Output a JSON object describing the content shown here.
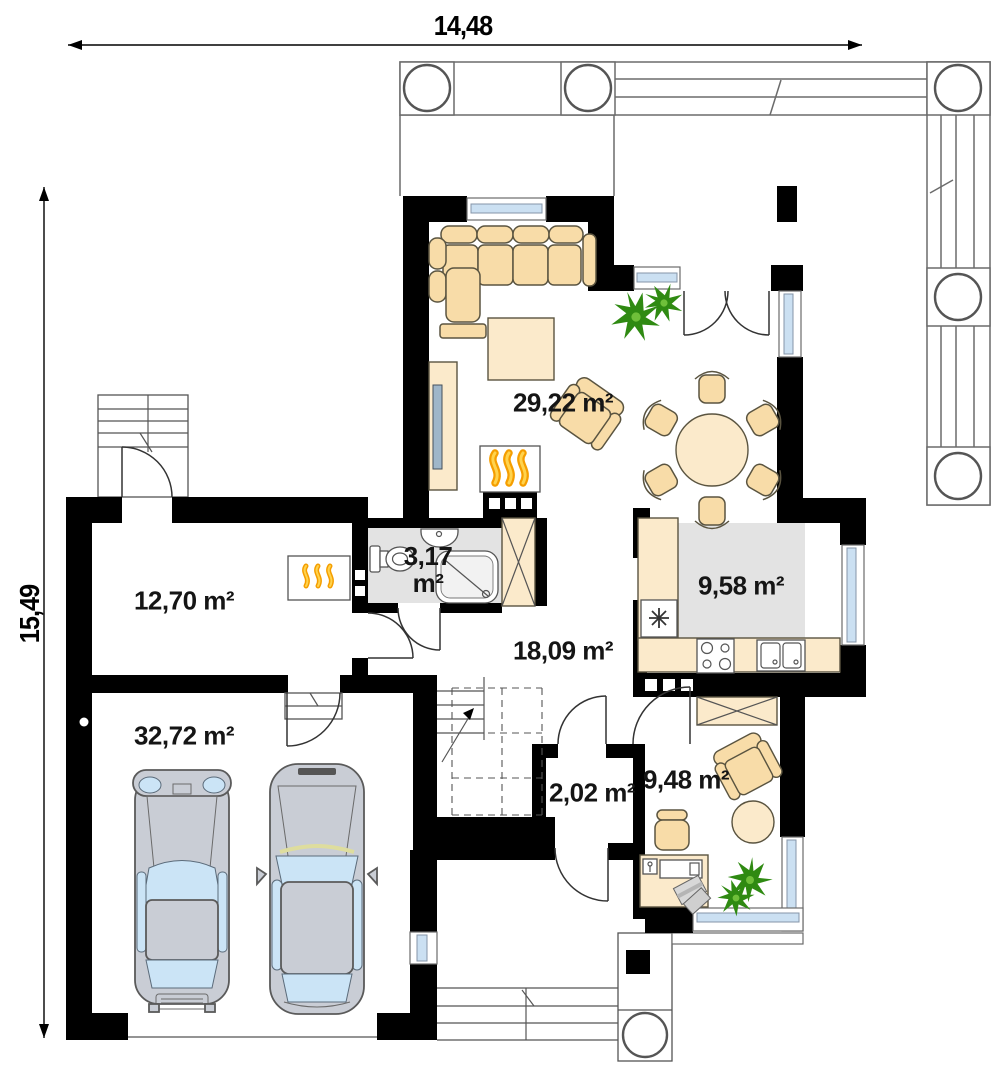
{
  "dimensions": {
    "width": "14,48",
    "height": "15,49"
  },
  "rooms": {
    "living": "29,22 m²",
    "utility": "12,70 m²",
    "bathroom": "3,17 m²",
    "hall": "18,09 m²",
    "kitchen": "9,58 m²",
    "garage": "32,72 m²",
    "vestibule": "2,02 m²",
    "office": "9,48 m²"
  },
  "colors": {
    "wall": "#000000",
    "furniture": "#F8DCA8",
    "furniture_light": "#FBEACB",
    "floor_gray": "#E3E3E3",
    "window_glass": "#CBE0F2",
    "plant_green": "#2F8A12",
    "flame_orange": "#F59E00",
    "car_body": "#C9CDD5",
    "car_glass": "#CBE4F6"
  }
}
